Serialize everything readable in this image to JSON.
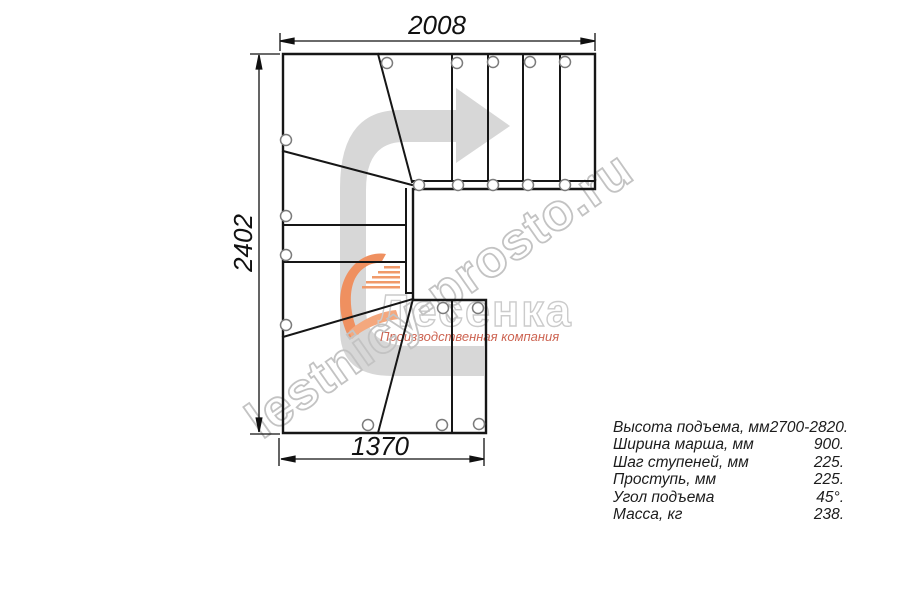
{
  "plan": {
    "dimensions": {
      "top_width_mm": "2008",
      "left_height_mm": "2402",
      "bottom_width_mm": "1370"
    }
  },
  "specs": {
    "rows": [
      {
        "label": "Высота подъема, мм",
        "value": "2700-2820."
      },
      {
        "label": "Ширина марша, мм",
        "value": "900."
      },
      {
        "label": "Шаг ступеней, мм",
        "value": "225."
      },
      {
        "label": "Проступь, мм",
        "value": "225."
      },
      {
        "label": "Угол подъема",
        "value": "45°."
      },
      {
        "label": "Масса, кг",
        "value": "238."
      }
    ]
  },
  "watermark": {
    "site_text": "lestnicy-prosto.ru"
  },
  "logo": {
    "brand": "Лесенка",
    "tagline": "Производственная компания"
  },
  "colors": {
    "line": "#161616",
    "dimension": "#111111",
    "direction_arrow": "#d7d7d7",
    "watermark_outline": "#c3c3c3",
    "logo_orange": "#ef9060",
    "logo_red": "#cd6452",
    "fastener_stroke": "#7b7b7b"
  }
}
